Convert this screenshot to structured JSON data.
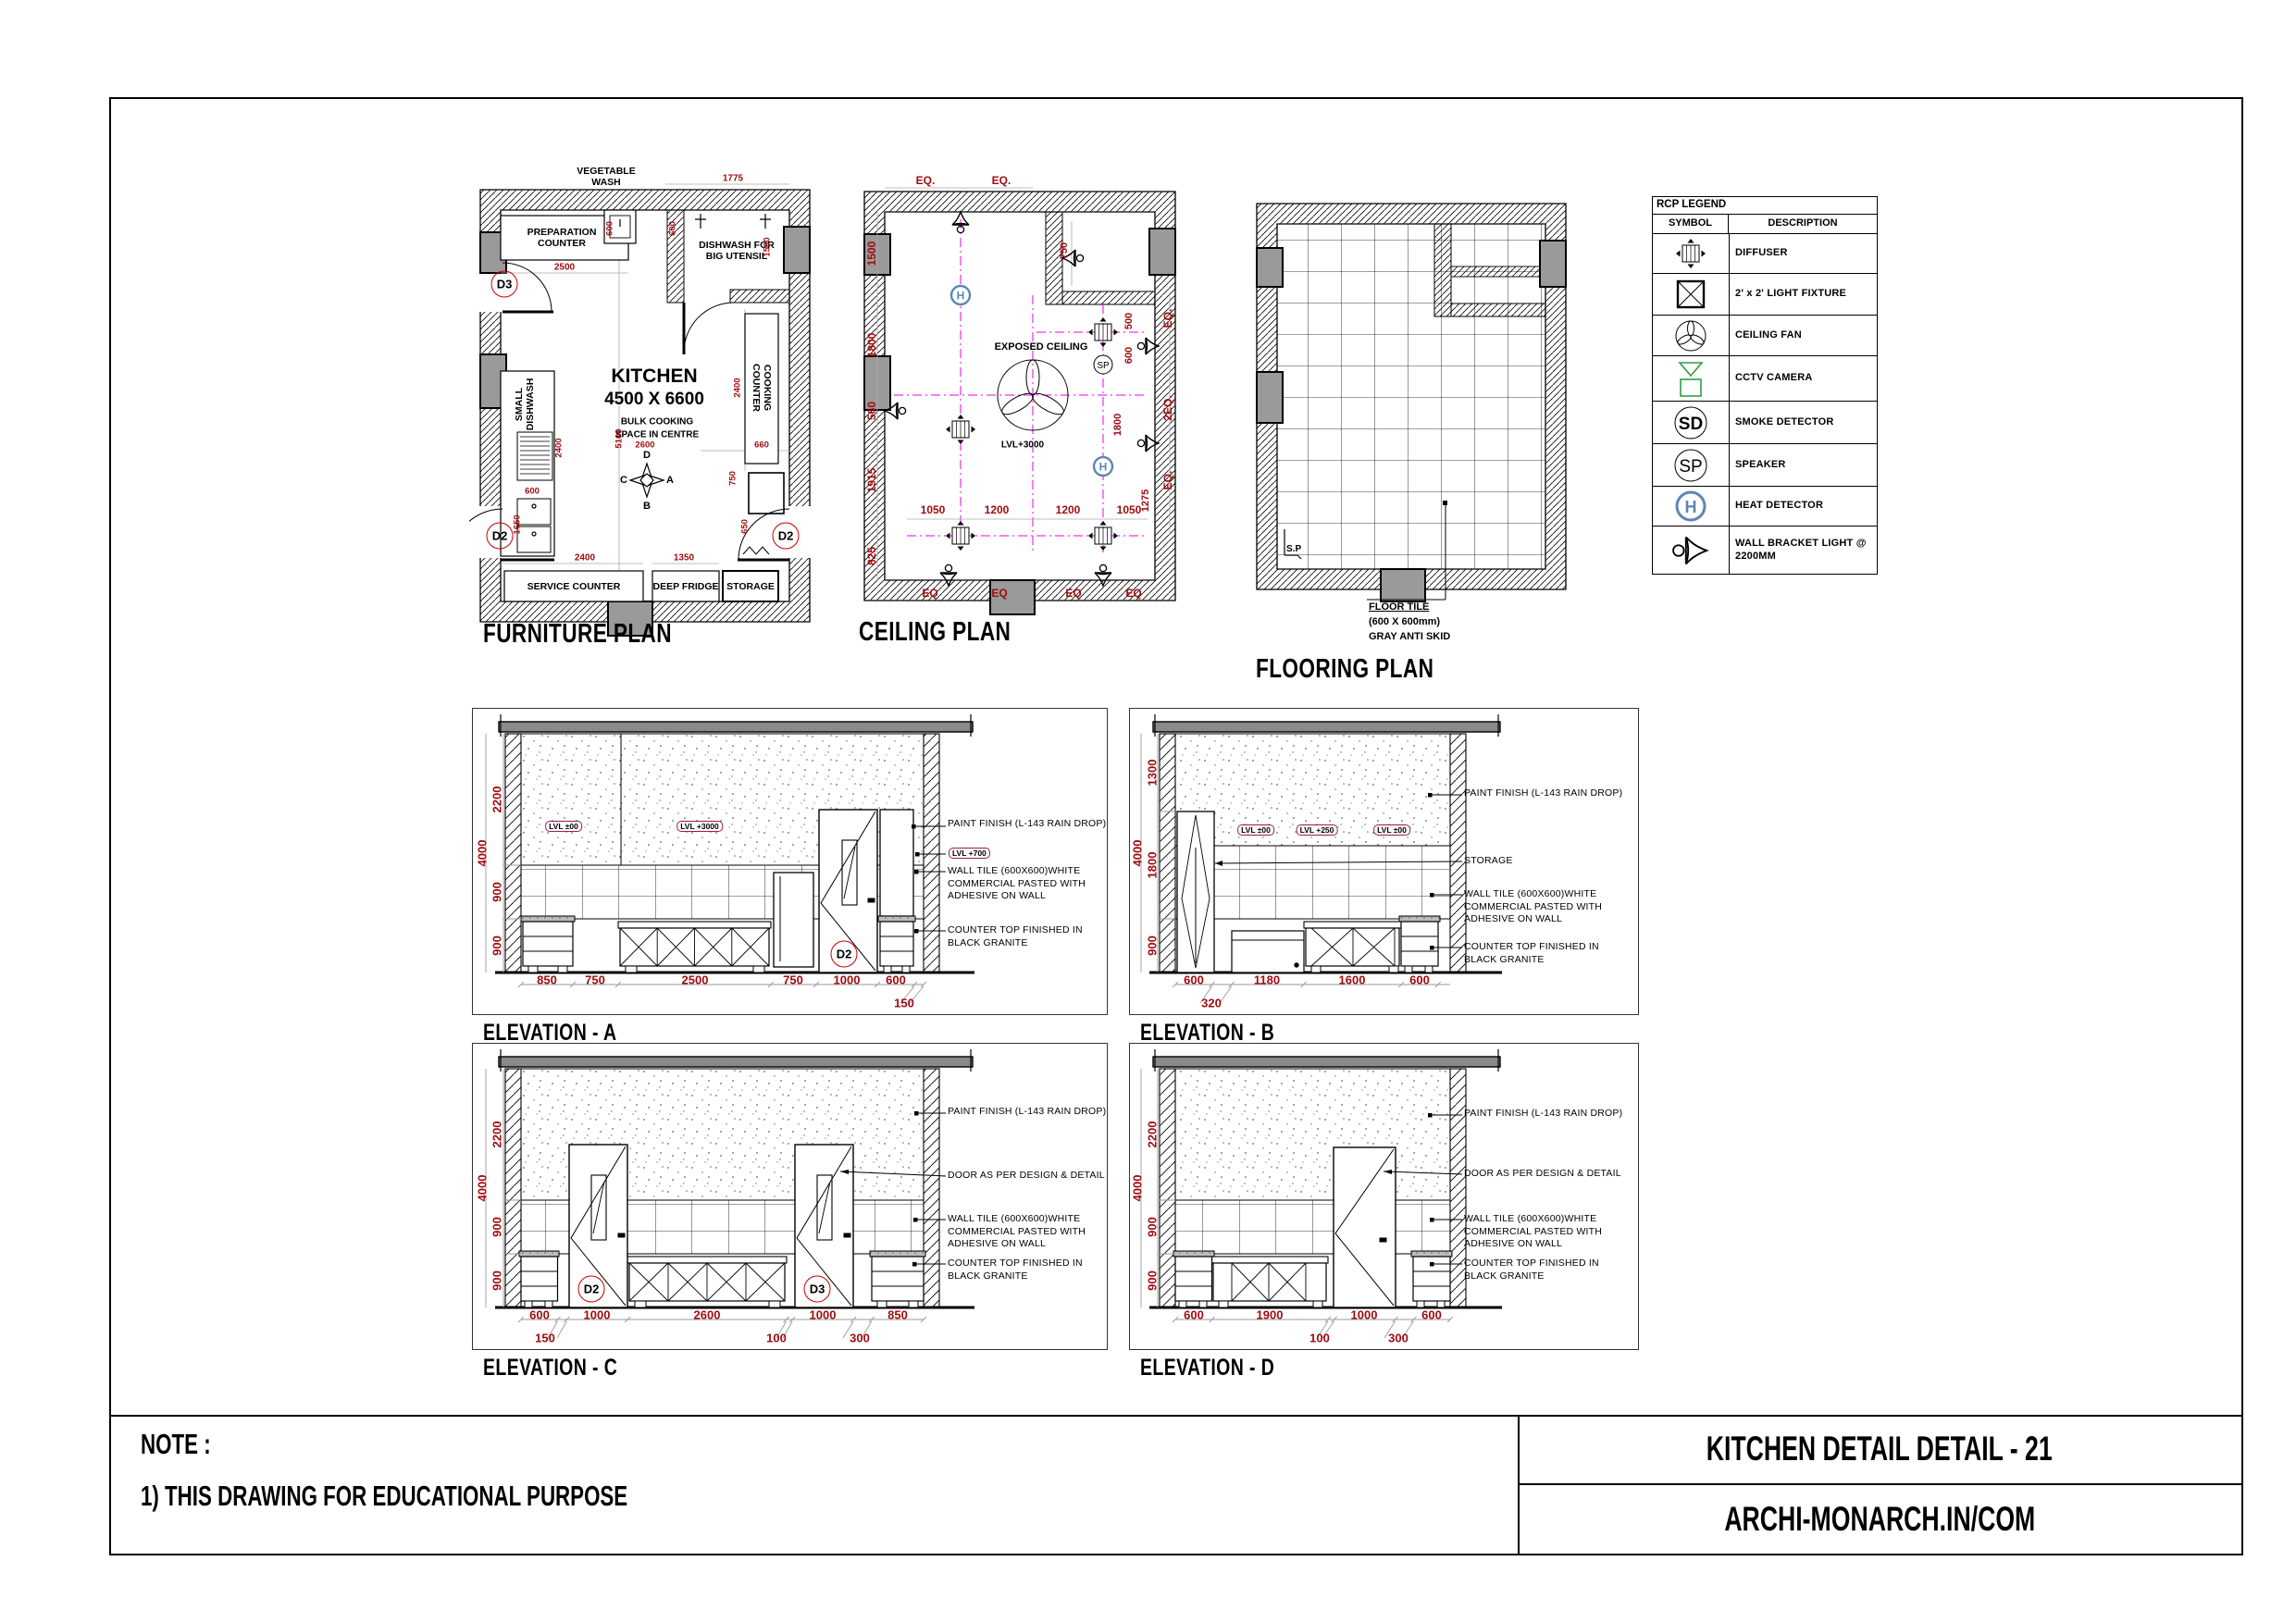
{
  "sheet": {
    "note_label": "NOTE :",
    "note_1": "1) THIS DRAWING FOR EDUCATIONAL PURPOSE",
    "title": "KITCHEN DETAIL DETAIL - 21",
    "website": "ARCHI-MONARCH.IN/COM"
  },
  "colors": {
    "dim_red": "#9e0b0f",
    "centerline_magenta": "#ee00ee",
    "heat_detector_blue": "#5b87b5",
    "cctv_green": "#2e9e46",
    "column_gray": "#9a9a9a",
    "slab_gray": "#8a8a8a"
  },
  "furniture_plan": {
    "title": "FURNITURE PLAN",
    "room": {
      "name": "KITCHEN",
      "size": "4500 X 6600",
      "note_line1": "BULK COOKING",
      "note_line2": "SPACE IN CENTRE"
    },
    "labels": {
      "vegetable_wash": "VEGETABLE WASH",
      "preparation_counter": "PREPARATION COUNTER",
      "dishwash_big": "DISHWASH FOR BIG UTENSIL",
      "small_dishwash": "SMALL DISHWASH",
      "cooking_counter": "COOKING COUNTER",
      "service_counter": "SERVICE COUNTER",
      "deep_fridge": "DEEP FRIDGE",
      "storage": "STORAGE"
    },
    "doors": {
      "d3": "D3",
      "d2_left": "D2",
      "d2_right": "D2"
    },
    "compass": {
      "top": "D",
      "right": "A",
      "bottom": "B",
      "left": "C"
    },
    "dims": {
      "top": "1775",
      "prep": "2500",
      "veg": "600",
      "alcove": "600",
      "alcove_depth": "1500",
      "dishwash": "2400",
      "centre_v": "5100",
      "centre_h": "2600",
      "sink": "600",
      "cooking": "2400",
      "cooking_w": "660",
      "appliance": "750",
      "door_left": "1650",
      "door_right": "650",
      "service": "2400",
      "fridge": "1350"
    }
  },
  "ceiling_plan": {
    "title": "CEILING PLAN",
    "labels": {
      "exposed_ceiling": "EXPOSED CEILING",
      "level": "LVL+3000"
    },
    "dims": {
      "top": [
        "EQ.",
        "EQ."
      ],
      "left": [
        "1500",
        "1800",
        "560",
        "1915",
        "825"
      ],
      "inner": [
        "750",
        "500",
        "600",
        "1800",
        "1275"
      ],
      "row": [
        "1050",
        "1200",
        "1200",
        "1050"
      ],
      "right": [
        "EQ.",
        "2EQ.",
        "EQ."
      ],
      "bottom": [
        "EQ",
        "EQ",
        "EQ",
        "EQ"
      ]
    }
  },
  "flooring_plan": {
    "title": "FLOORING PLAN",
    "sp": "S.P",
    "callout_line1": "FLOOR TILE",
    "callout_line2": "(600 X 600mm)",
    "callout_line3": "GRAY ANTI SKID"
  },
  "rcp_legend": {
    "title": "RCP LEGEND",
    "symbol_header": "SYMBOL",
    "description_header": "DESCRIPTION",
    "rows": [
      {
        "icon": "diffuser-icon",
        "desc": "DIFFUSER"
      },
      {
        "icon": "light-fixture-icon",
        "desc": "2' x 2' LIGHT FIXTURE"
      },
      {
        "icon": "ceiling-fan-icon",
        "desc": "CEILING FAN"
      },
      {
        "icon": "cctv-camera-icon",
        "desc": "CCTV CAMERA"
      },
      {
        "icon": "smoke-detector-icon",
        "desc": "SMOKE DETECTOR",
        "glyph": "SD"
      },
      {
        "icon": "speaker-icon",
        "desc": "SPEAKER",
        "glyph": "SP"
      },
      {
        "icon": "heat-detector-icon",
        "desc": "HEAT DETECTOR",
        "glyph": "H"
      },
      {
        "icon": "wall-bracket-light-icon",
        "desc": "WALL BRACKET LIGHT @ 2200MM"
      }
    ]
  },
  "elevations": {
    "a": {
      "title": "ELEVATION - A",
      "door_label": "D2",
      "levels": [
        "LVL ±00",
        "LVL +3000"
      ],
      "level_callout": "LVL +700",
      "dim_total": "4000",
      "dims_left": [
        "2200",
        "900",
        "900"
      ],
      "dims_bottom": [
        "850",
        "750",
        "2500",
        "750",
        "1000",
        "600"
      ],
      "dims_offset": [
        "150"
      ],
      "ann_paint": "PAINT FINISH (L-143 RAIN DROP)",
      "ann_tile": "WALL TILE (600X600)WHITE COMMERCIAL PASTED WITH ADHESIVE ON WALL",
      "ann_counter": "COUNTER TOP FINISHED IN BLACK GRANITE"
    },
    "b": {
      "title": "ELEVATION - B",
      "levels": [
        "LVL ±00",
        "LVL +250",
        "LVL ±00"
      ],
      "dim_total": "4000",
      "dims_left": [
        "1300",
        "1800",
        "900"
      ],
      "dims_bottom": [
        "600",
        "1180",
        "1600",
        "600"
      ],
      "dims_offset": [
        "320"
      ],
      "ann_paint": "PAINT FINISH (L-143 RAIN DROP)",
      "ann_storage": "STORAGE",
      "ann_tile": "WALL TILE (600X600)WHITE COMMERCIAL PASTED WITH ADHESIVE ON WALL",
      "ann_counter": "COUNTER TOP FINISHED IN BLACK GRANITE"
    },
    "c": {
      "title": "ELEVATION - C",
      "door_labels": [
        "D2",
        "D3"
      ],
      "dim_total": "4000",
      "dims_left": [
        "2200",
        "900",
        "900"
      ],
      "dims_bottom": [
        "600",
        "1000",
        "2600",
        "1000",
        "850"
      ],
      "dims_offset": [
        "150",
        "100",
        "300"
      ],
      "ann_paint": "PAINT FINISH (L-143 RAIN DROP)",
      "ann_door": "DOOR AS PER DESIGN & DETAIL",
      "ann_tile": "WALL TILE (600X600)WHITE COMMERCIAL PASTED WITH ADHESIVE ON WALL",
      "ann_counter": "COUNTER TOP FINISHED IN BLACK GRANITE"
    },
    "d": {
      "title": "ELEVATION - D",
      "dim_total": "4000",
      "dims_left": [
        "2200",
        "900",
        "900"
      ],
      "dims_bottom": [
        "600",
        "1900",
        "1000",
        "600"
      ],
      "dims_offset": [
        "100",
        "300"
      ],
      "ann_paint": "PAINT FINISH (L-143 RAIN DROP)",
      "ann_door": "DOOR AS PER DESIGN & DETAIL",
      "ann_tile": "WALL TILE (600X600)WHITE COMMERCIAL PASTED WITH ADHESIVE ON WALL",
      "ann_counter": "COUNTER TOP FINISHED IN BLACK GRANITE"
    }
  }
}
